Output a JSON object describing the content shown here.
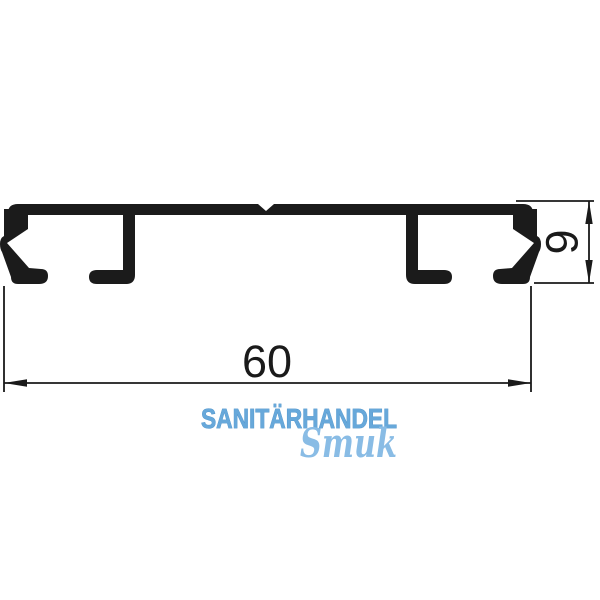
{
  "drawing": {
    "type": "aluminium profile cross-section, technical drawing",
    "dimensions": {
      "width": {
        "label": "60"
      },
      "height": {
        "label": "9"
      }
    },
    "colors": {
      "line_color": "#1a1a1a",
      "profile_fill": "#1b1b1b"
    }
  },
  "watermark": {
    "line1": "SANITÄRHANDEL",
    "line2": "Smuk",
    "color_line1": "#67a8da",
    "color_line1_stroke": "#4a90c8",
    "color_line2": "#89bce5"
  }
}
